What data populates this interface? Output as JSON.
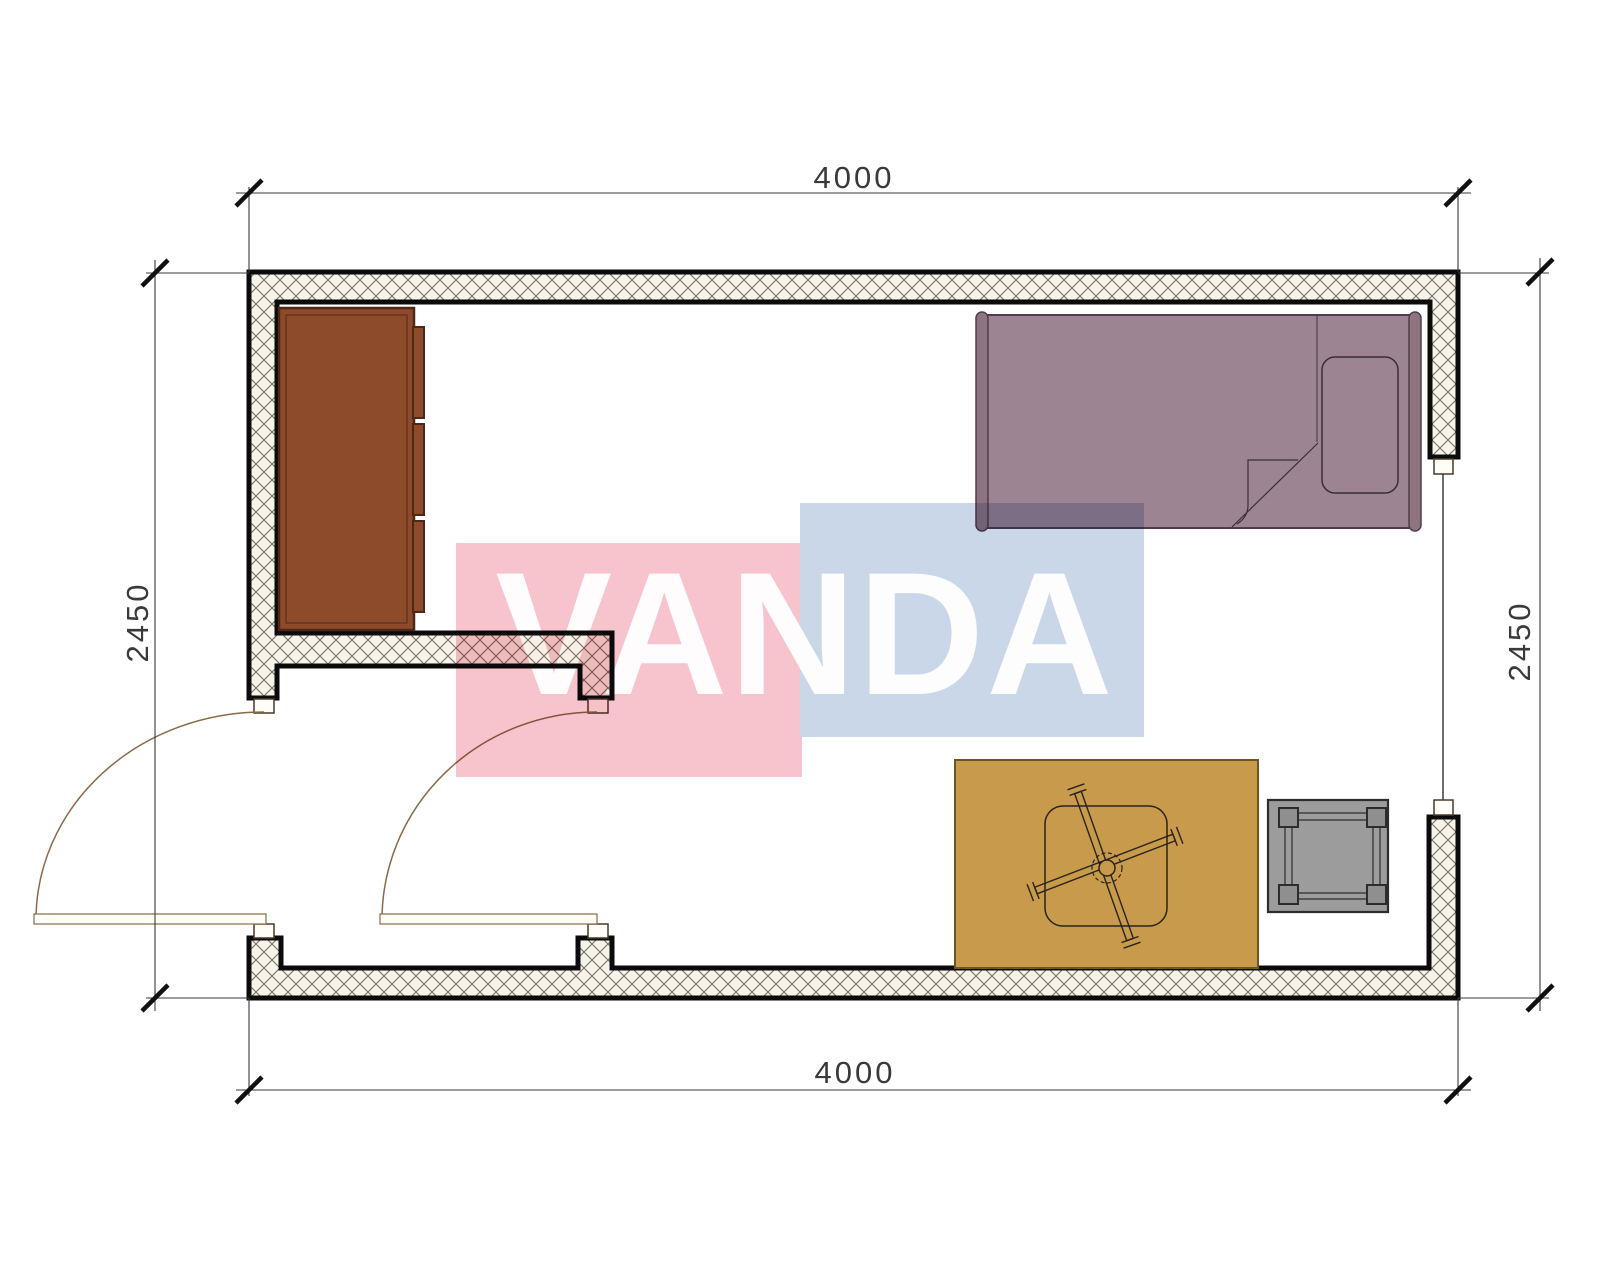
{
  "watermark": {
    "text": "VANDA",
    "pink_color": "#f7c4cd",
    "blue_color": "#cad7e8",
    "text_color": "#ffffff"
  },
  "dimensions": {
    "top": "4000",
    "bottom": "4000",
    "left": "2450",
    "right": "2450"
  },
  "plan": {
    "type": "floor-plan",
    "room_width_mm": 4000,
    "room_depth_mm": 2450,
    "wall_outline_color": "#0b0b0b",
    "hatch_line_color": "#7a7060",
    "hatch_bg_color": "#f6f3ea",
    "door_swing_color": "#8a6a48",
    "door_count": 2,
    "window_count": 1,
    "furniture": [
      {
        "name": "wardrobe",
        "color": "#8d4b2c"
      },
      {
        "name": "bed",
        "color": "#9d8492"
      },
      {
        "name": "pillow",
        "color": "#9d8492"
      },
      {
        "name": "rug",
        "color": "#c79b4b"
      },
      {
        "name": "table",
        "color": "#c79b4b"
      },
      {
        "name": "stool",
        "color": "#9c9c9c"
      }
    ]
  }
}
